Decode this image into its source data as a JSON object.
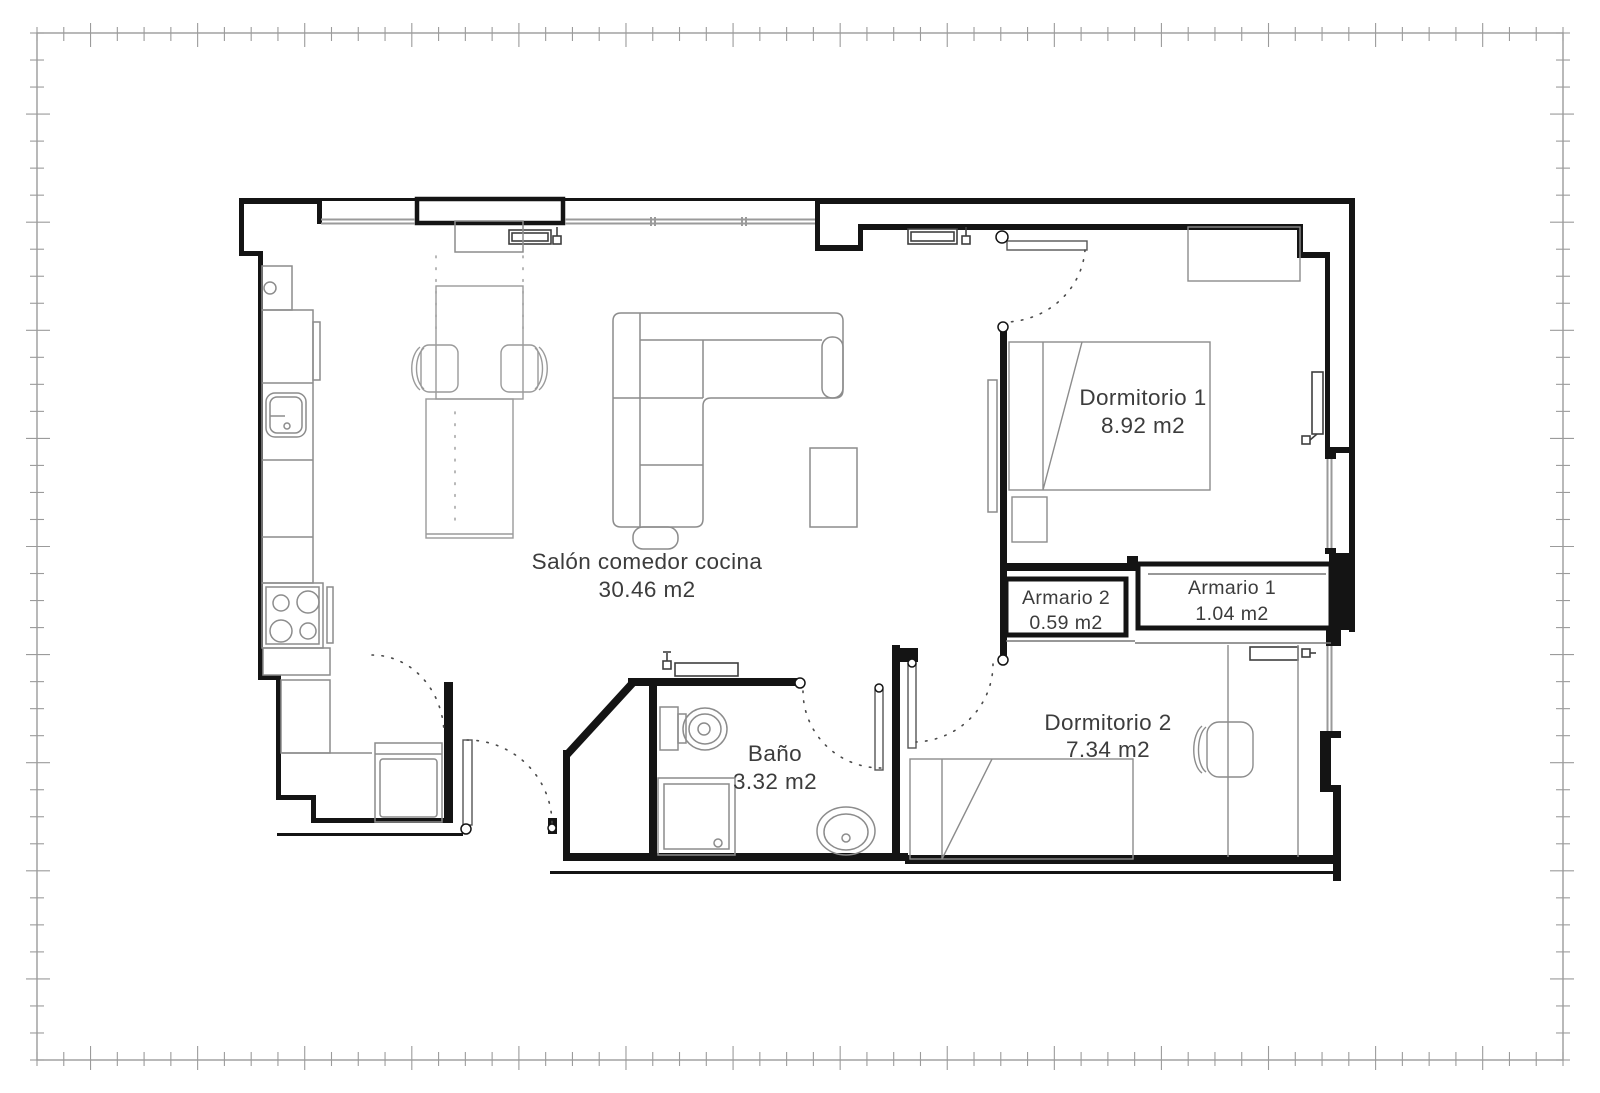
{
  "drawing": {
    "type": "apartment-floor-plan",
    "units": "m2"
  },
  "colors": {
    "wall": "#141414",
    "furniture_line": "#8c8c8c",
    "window_line": "#9a9a9a",
    "frame_line": "#9b9b9b",
    "label_text": "#3c3c3c",
    "background": "#ffffff"
  },
  "rooms": {
    "salon": {
      "name": "Salón comedor cocina",
      "area": "30.46 m2"
    },
    "dormitorio1": {
      "name": "Dormitorio 1",
      "area": "8.92 m2"
    },
    "armario2": {
      "name": "Armario 2",
      "area": "0.59 m2"
    },
    "armario1": {
      "name": "Armario 1",
      "area": "1.04 m2"
    },
    "bano": {
      "name": "Baño",
      "area": "3.32 m2"
    },
    "dormitorio2": {
      "name": "Dormitorio 2",
      "area": "7.34 m2"
    }
  }
}
